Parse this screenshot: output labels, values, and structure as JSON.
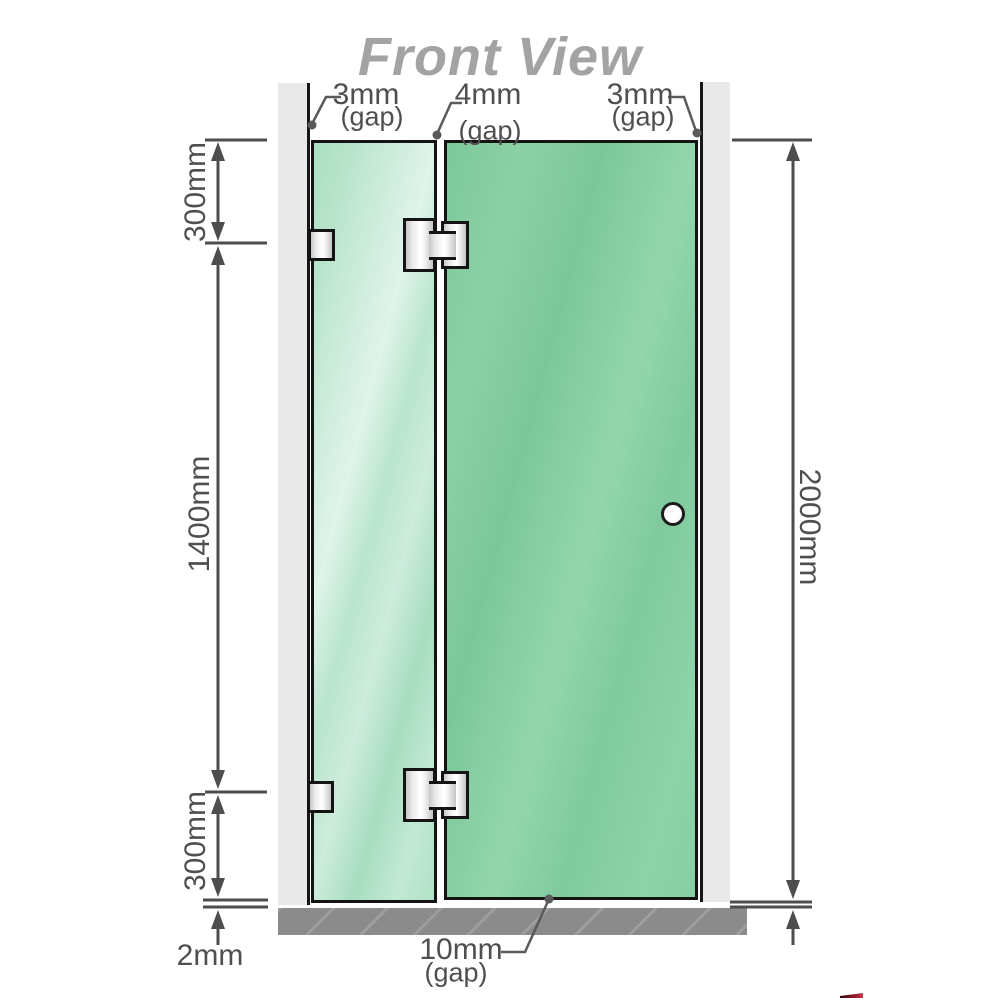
{
  "title": "Front View",
  "annotations": {
    "top_gaps": [
      {
        "value": "3mm",
        "qualifier": "(gap)"
      },
      {
        "value": "4mm",
        "qualifier": "(gap)"
      },
      {
        "value": "3mm",
        "qualifier": "(gap)"
      }
    ],
    "left": [
      "300mm",
      "1400mm",
      "300mm"
    ],
    "right": "2000mm",
    "floor_gap": "2mm",
    "bottom_gap": {
      "value": "10mm",
      "qualifier": "(gap)"
    }
  },
  "colors": {
    "glass_green": "#87cea3",
    "glass_green_light": "#c2e9d4",
    "wall_gray": "#e9e9e9",
    "floor_gray": "#8b8b8b",
    "dimension_gray": "#4f4f4f",
    "title_gray": "#a3a3a3",
    "metal_silver": "#ececec"
  }
}
